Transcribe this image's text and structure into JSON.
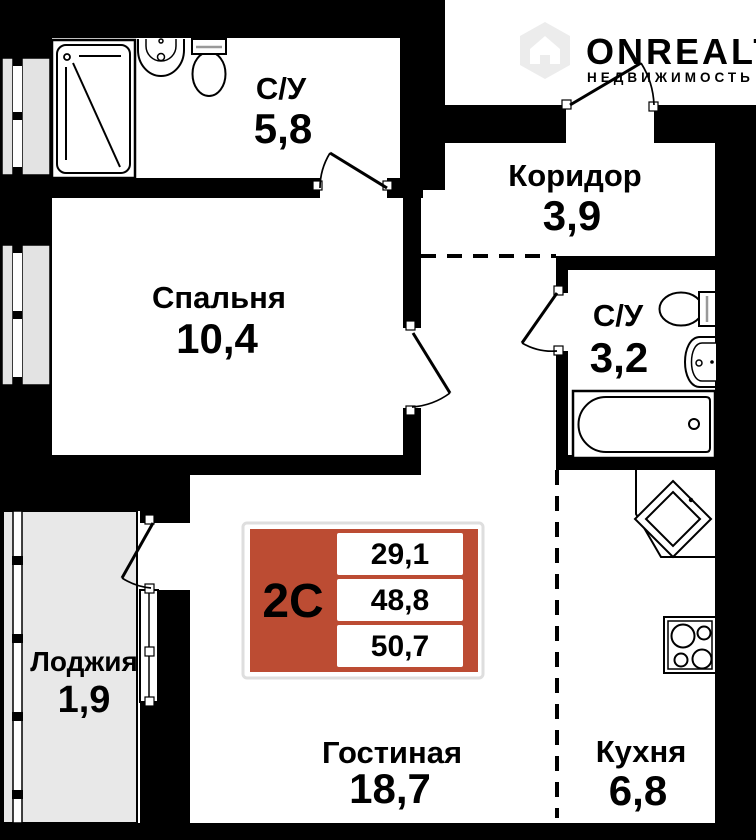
{
  "rooms": [
    {
      "name": "С/У",
      "area": "5,8"
    },
    {
      "name": "Коридор",
      "area": "3,9"
    },
    {
      "name": "Спальня",
      "area": "10,4"
    },
    {
      "name": "С/У",
      "area": "3,2"
    },
    {
      "name": "Лоджия",
      "area": "1,9"
    },
    {
      "name": "Гостиная",
      "area": "18,7"
    },
    {
      "name": "Кухня",
      "area": "6,8"
    }
  ],
  "badge": {
    "type_label": "2С",
    "values": [
      "29,1",
      "48,8",
      "50,7"
    ]
  },
  "logo": {
    "title": "ONREALT",
    "subtitle": "НЕДВИЖИМОСТЬ"
  },
  "colors": {
    "wall": "#000000",
    "badge_red": "#bc4c33",
    "loggia_fill": "#e8e8e8",
    "window_fill": "#e3e3e3",
    "watermark": "#ececec"
  }
}
